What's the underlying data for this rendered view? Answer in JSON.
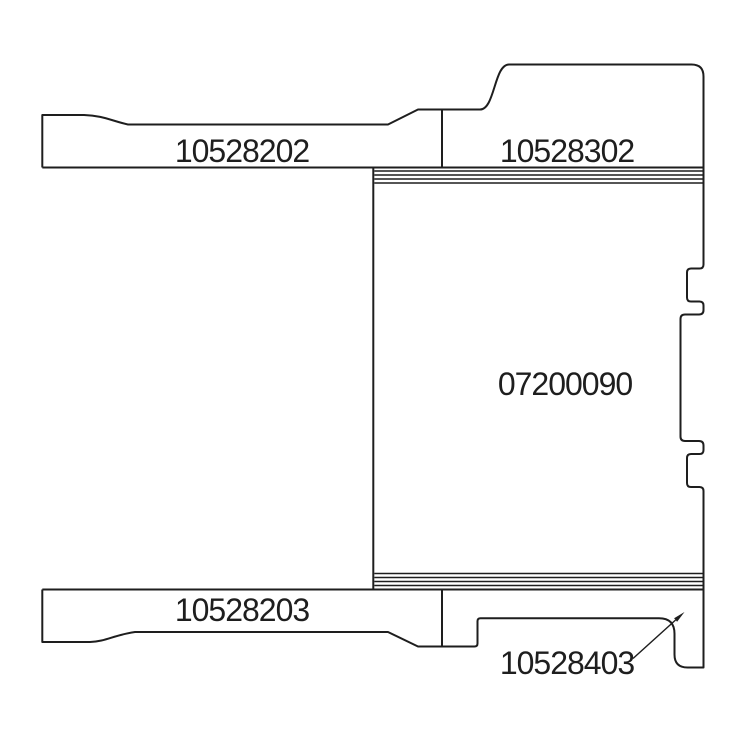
{
  "diagram": {
    "background_color": "#ffffff",
    "line_color": "#1e1e1e",
    "parts": {
      "upper_left_plate": "10528202",
      "upper_right_cap": "10528302",
      "center_body": "07200090",
      "lower_left_plate": "10528203",
      "lower_right_foot": "10528403"
    }
  }
}
